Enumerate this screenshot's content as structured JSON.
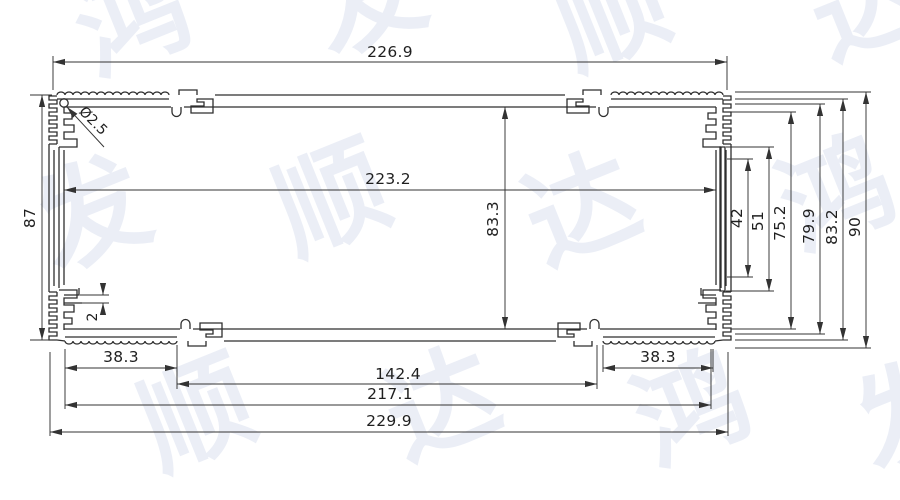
{
  "drawing_title": "aluminum-extrusion-profile-cross-section",
  "watermark": {
    "text": "鸿发顺达",
    "chars": [
      "鸿",
      "发",
      "顺",
      "达",
      "发",
      "顺",
      "达",
      "鸿",
      "顺",
      "达",
      "鸿",
      "发"
    ]
  },
  "dimensions": {
    "top_outer_width": "226.9",
    "top_inner_width": "223.2",
    "overall_width": "229.9",
    "fin_span_width": "217.1",
    "flat_center_width": "142.4",
    "knurl_width_left": "38.3",
    "knurl_width_right": "38.3",
    "left_wall_height": "87",
    "cavity_height": "83.3",
    "overall_height": "90",
    "step_height_3": "83.2",
    "step_height_2": "79.9",
    "step_height_1": "75.2",
    "slot_outer_length": "51",
    "slot_inner_length": "42",
    "rib_thickness": "2",
    "screw_hole_dia": "Ø2.5"
  }
}
